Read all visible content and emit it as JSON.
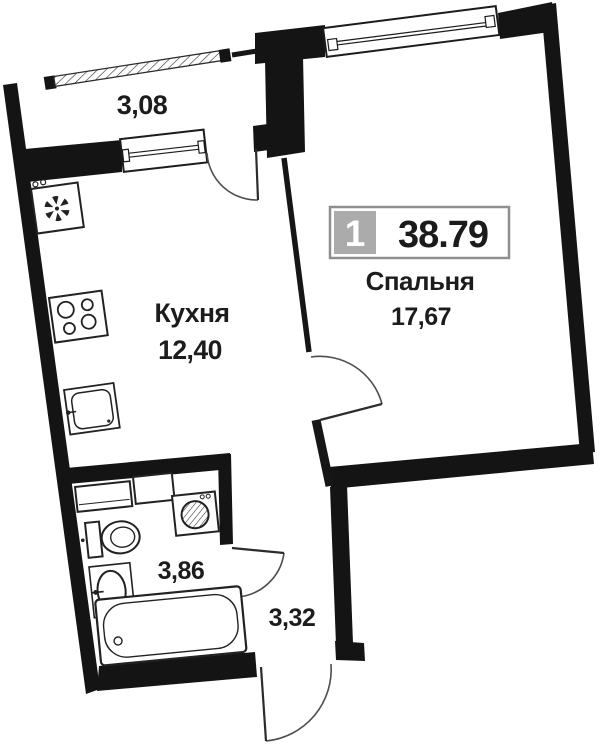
{
  "floor_plan": {
    "unit_badge": {
      "unit_number": "1",
      "total_area": "38.79"
    },
    "rooms": {
      "balcony": {
        "area": "3,08"
      },
      "kitchen": {
        "name": "Кухня",
        "area": "12,40"
      },
      "bedroom": {
        "name": "Спальня",
        "area": "17,67"
      },
      "bathroom": {
        "area": "3,86"
      },
      "hallway": {
        "area": "3,32"
      }
    },
    "colors": {
      "wall": "#141414",
      "badge_gray": "#ababab",
      "badge_border": "#8f8f8f",
      "text": "#1c1c1c",
      "thin_line": "#4d4d4d"
    }
  }
}
